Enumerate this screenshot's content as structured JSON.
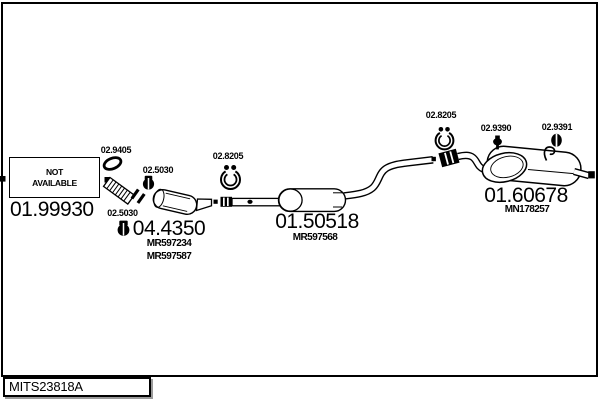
{
  "colors": {
    "line": "#000000",
    "background": "#ffffff",
    "box_shadow": "#9a9a9a"
  },
  "footer": {
    "drawing_code": "MITS23818A"
  },
  "diagram": {
    "not_available": {
      "line1": "NOT",
      "line2": "AVAILABLE"
    },
    "front_pipe": {
      "number": "01.99930"
    },
    "gasket": {
      "number": "02.9405"
    },
    "clamp_front_upper": {
      "number": "02.5030"
    },
    "clamp_front_lower": {
      "number": "02.5030"
    },
    "catalytic_converter": {
      "number": "04.4350",
      "ref1": "MR597234",
      "ref2": "MR597587"
    },
    "clamp_centre": {
      "number": "02.8205"
    },
    "centre_silencer": {
      "number": "01.50518",
      "ref": "MR597568"
    },
    "clamp_rear": {
      "number": "02.8205"
    },
    "hanger_pin": {
      "number": "02.9390"
    },
    "hanger_grommet": {
      "number": "02.9391"
    },
    "rear_silencer": {
      "number": "01.60678",
      "ref": "MN178257"
    }
  }
}
